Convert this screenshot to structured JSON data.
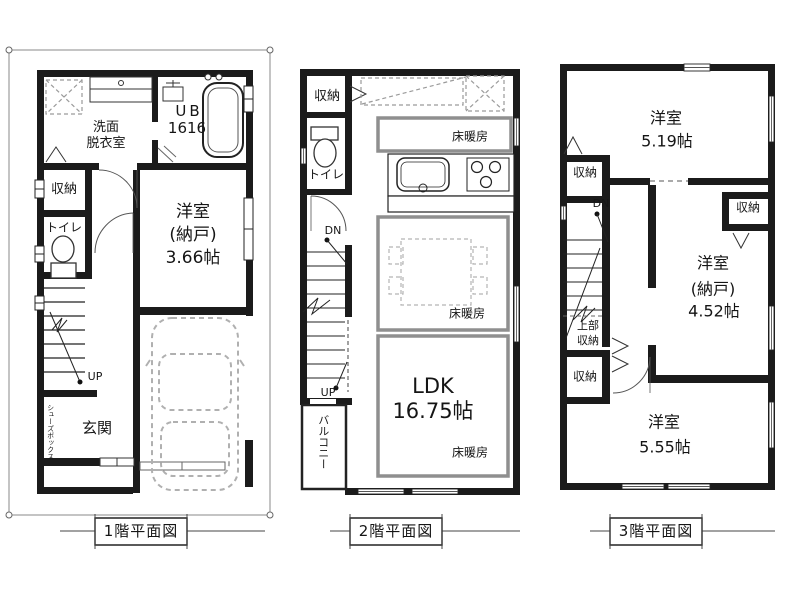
{
  "document": {
    "type": "floor-plan",
    "background": "#ffffff",
    "wall_color": "#1b1b1b",
    "heating_border_color": "#8f8f8f",
    "boundary_color": "#8a8a8a"
  },
  "floors": {
    "f1": {
      "title": "1階平面図",
      "rooms": {
        "washroom": [
          "洗面",
          "脱衣室"
        ],
        "unit_bath": [
          "UB",
          "1616"
        ],
        "storage": "収納",
        "toilet": "トイレ",
        "western_room": [
          "洋室",
          "(納戸)",
          "3.66帖"
        ],
        "entrance": "玄関",
        "shoe_box": "シューズボックス",
        "stairs_up": "UP"
      }
    },
    "f2": {
      "title": "2階平面図",
      "rooms": {
        "storage": "収納",
        "toilet": "トイレ",
        "stairs_down": "DN",
        "stairs_up": "UP",
        "balcony": "バルコニー",
        "floor_heating": "床暖房",
        "ldk": [
          "LDK",
          "16.75帖"
        ]
      }
    },
    "f3": {
      "title": "3階平面図",
      "rooms": {
        "western_room_519": [
          "洋室",
          "5.19帖"
        ],
        "storage_a": "収納",
        "storage_b": "収納",
        "storage_c": "収納",
        "upper_storage": [
          "上部",
          "収納"
        ],
        "western_room_nando": [
          "洋室",
          "(納戸)",
          "4.52帖"
        ],
        "western_room_555": [
          "洋室",
          "5.55帖"
        ],
        "stairs_down": "DN"
      }
    }
  }
}
